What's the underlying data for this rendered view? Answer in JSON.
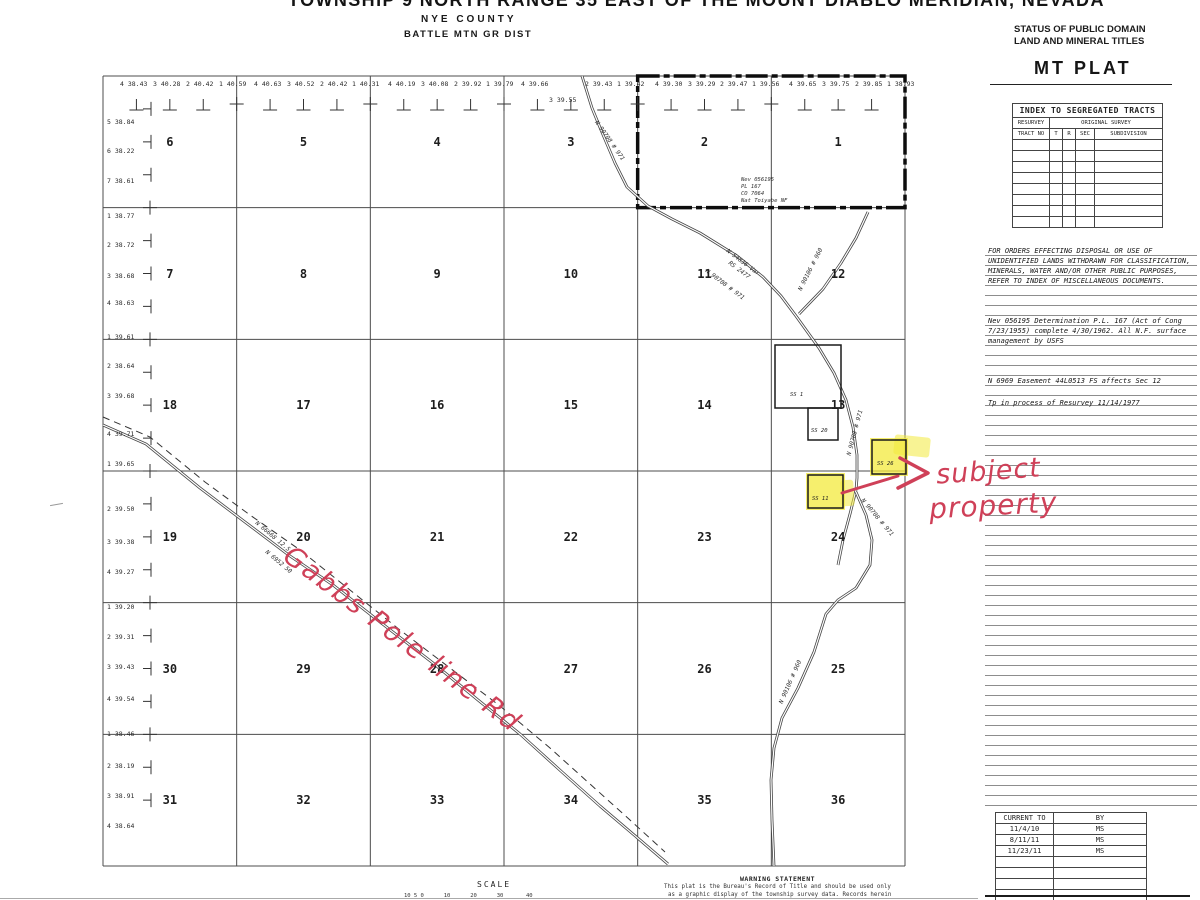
{
  "page": {
    "title": "TOWNSHIP 9 NORTH RANGE 35 EAST OF THE MOUNT DIABLO MERIDIAN, NEVADA",
    "county": "NYE COUNTY",
    "district": "BATTLE MTN GR DIST"
  },
  "corner": {
    "status_line1": "STATUS OF PUBLIC DOMAIN",
    "status_line2": "LAND AND MINERAL TITLES",
    "plat_label": "MT PLAT"
  },
  "index_table": {
    "title": "INDEX TO SEGREGATED TRACTS",
    "col_resurvey": "RESURVEY",
    "col_original": "ORIGINAL SURVEY",
    "headers": [
      "TRACT NO",
      "T",
      "R",
      "SEC",
      "SUBDIVISION"
    ],
    "empty_rows": 8
  },
  "notes": {
    "para1": [
      "FOR ORDERS EFFECTING DISPOSAL OR USE OF",
      "UNIDENTIFIED LANDS WITHDRAWN FOR CLASSIFICATION,",
      "MINERALS, WATER AND/OR OTHER PUBLIC PURPOSES,",
      "REFER TO INDEX OF MISCELLANEOUS DOCUMENTS."
    ],
    "para2": [
      "Nev 056195 Determination P.L. 167 (Act of Cong",
      "7/23/1955) complete 4/30/1962.  All N.F. surface",
      "management by USFS"
    ],
    "note3": "N 6969 Easement 44L0513 FS affects Sec 12",
    "note4": "Tp in process of Resurvey 11/14/1977"
  },
  "history_table": {
    "headers": [
      "CURRENT TO",
      "BY"
    ],
    "rows": [
      [
        "11/4/10",
        "MS"
      ],
      [
        "8/11/11",
        "MS"
      ],
      [
        "11/23/11",
        "MS"
      ]
    ],
    "empty_rows": 4
  },
  "map": {
    "sections": [
      6,
      5,
      4,
      3,
      2,
      1,
      7,
      8,
      9,
      10,
      11,
      12,
      18,
      17,
      16,
      15,
      14,
      13,
      19,
      20,
      21,
      22,
      23,
      24,
      30,
      29,
      28,
      27,
      26,
      25,
      31,
      32,
      33,
      34,
      35,
      36
    ],
    "top_labels": [
      {
        "t": "4 38.43",
        "x": 120
      },
      {
        "t": "3 40.28",
        "x": 153
      },
      {
        "t": "2 40.42",
        "x": 186
      },
      {
        "t": "1 40.59",
        "x": 219
      },
      {
        "t": "4 40.63",
        "x": 254
      },
      {
        "t": "3 40.52",
        "x": 287
      },
      {
        "t": "2 40.42",
        "x": 320
      },
      {
        "t": "1 40.31",
        "x": 352
      },
      {
        "t": "4 40.19",
        "x": 388
      },
      {
        "t": "3 40.08",
        "x": 421
      },
      {
        "t": "2 39.92",
        "x": 454
      },
      {
        "t": "1 39.79",
        "x": 486
      },
      {
        "t": "4 39.66",
        "x": 521
      },
      {
        "t": "3 39.55",
        "x": 549,
        "y": 96
      },
      {
        "t": "2 39.43",
        "x": 585
      },
      {
        "t": "1 39.42",
        "x": 617
      },
      {
        "t": "4 39.30",
        "x": 655
      },
      {
        "t": "3 39.29",
        "x": 688
      },
      {
        "t": "2 39.47",
        "x": 720
      },
      {
        "t": "1 39.56",
        "x": 752
      },
      {
        "t": "4 39.65",
        "x": 789
      },
      {
        "t": "3 39.75",
        "x": 822
      },
      {
        "t": "2 39.85",
        "x": 855
      },
      {
        "t": "1 38.93",
        "x": 887
      }
    ],
    "left_labels": [
      {
        "t": "5 38.84",
        "y": 118
      },
      {
        "t": "6 38.22",
        "y": 147
      },
      {
        "t": "7 38.61",
        "y": 177
      },
      {
        "t": "1 38.77",
        "y": 212
      },
      {
        "t": "2 38.72",
        "y": 241
      },
      {
        "t": "3 38.68",
        "y": 272
      },
      {
        "t": "4 38.63",
        "y": 299
      },
      {
        "t": "1 39.61",
        "y": 333
      },
      {
        "t": "2 38.64",
        "y": 362
      },
      {
        "t": "3 39.68",
        "y": 392
      },
      {
        "t": "4 39.71",
        "y": 430
      },
      {
        "t": "1 39.65",
        "y": 460
      },
      {
        "t": "2 39.50",
        "y": 505
      },
      {
        "t": "3 39.38",
        "y": 538
      },
      {
        "t": "4 39.27",
        "y": 568
      },
      {
        "t": "1 39.20",
        "y": 603
      },
      {
        "t": "2 39.31",
        "y": 633
      },
      {
        "t": "3 39.43",
        "y": 663
      },
      {
        "t": "4 39.54",
        "y": 695
      },
      {
        "t": "1 38.46",
        "y": 730
      },
      {
        "t": "2 38.19",
        "y": 762
      },
      {
        "t": "3 38.91",
        "y": 792
      },
      {
        "t": "4 38.64",
        "y": 822
      }
    ],
    "sec2_note": [
      "Nev 056195",
      "PL 167",
      "CO 7064",
      "Nat Toiyabe NF"
    ],
    "road_labels": [
      {
        "t": "N 90708 # 971",
        "x": 596,
        "y": 118,
        "r": 55
      },
      {
        "t": "N 54836 Var",
        "x": 727,
        "y": 247,
        "r": 37
      },
      {
        "t": "RS 2477",
        "x": 729,
        "y": 259,
        "r": 37
      },
      {
        "t": "N 90708 # 971",
        "x": 706,
        "y": 267,
        "r": 37
      },
      {
        "t": "N 90106 # 960",
        "x": 800,
        "y": 287,
        "r": -63
      },
      {
        "t": "N 90708 # 971",
        "x": 849,
        "y": 452,
        "r": -75
      },
      {
        "t": "N 90708 # 971",
        "x": 862,
        "y": 496,
        "r": 50
      },
      {
        "t": "N 90106 # 960",
        "x": 781,
        "y": 700,
        "r": -66
      },
      {
        "t": "N 66668 12.5",
        "x": 256,
        "y": 519,
        "r": 40
      },
      {
        "t": "N 6952 50",
        "x": 266,
        "y": 548,
        "r": 40
      }
    ],
    "surveys": [
      {
        "label": "SS 1",
        "x": 775,
        "y": 345,
        "w": 66,
        "h": 63,
        "hl": false,
        "lx": 790,
        "ly": 392
      },
      {
        "label": "SS 20",
        "x": 808,
        "y": 408,
        "w": 30,
        "h": 32,
        "hl": false,
        "lx": 811,
        "ly": 428
      },
      {
        "label": "SS 26",
        "x": 872,
        "y": 440,
        "w": 34,
        "h": 34,
        "hl": true,
        "lx": 877,
        "ly": 461
      },
      {
        "label": "SS 11",
        "x": 808,
        "y": 475,
        "w": 35,
        "h": 33,
        "hl": true,
        "lx": 812,
        "ly": 496
      }
    ],
    "highlight_smudges": [
      {
        "x": 894,
        "y": 436,
        "w": 36,
        "h": 20,
        "r": 6
      },
      {
        "x": 841,
        "y": 480,
        "w": 13,
        "h": 26,
        "r": -4
      }
    ],
    "roads": [
      {
        "name": "route-971-north",
        "pts": [
          [
            582,
            76
          ],
          [
            592,
            108
          ],
          [
            601,
            130
          ],
          [
            615,
            163
          ],
          [
            627,
            187
          ],
          [
            648,
            206
          ],
          [
            672,
            219
          ],
          [
            700,
            233
          ],
          [
            737,
            256
          ],
          [
            763,
            277
          ],
          [
            781,
            296
          ],
          [
            796,
            316
          ],
          [
            819,
            348
          ],
          [
            834,
            373
          ],
          [
            846,
            400
          ],
          [
            853,
            427
          ],
          [
            857,
            455
          ],
          [
            857,
            478
          ],
          [
            856,
            490
          ]
        ]
      },
      {
        "name": "route-971-branch",
        "pts": [
          [
            856,
            490
          ],
          [
            850,
            514
          ],
          [
            843,
            540
          ],
          [
            838,
            565
          ]
        ]
      },
      {
        "name": "route-960-north",
        "pts": [
          [
            868,
            212
          ],
          [
            856,
            238
          ],
          [
            841,
            263
          ],
          [
            823,
            289
          ],
          [
            799,
            314
          ]
        ]
      },
      {
        "name": "route-960-south",
        "pts": [
          [
            856,
            492
          ],
          [
            866,
            515
          ],
          [
            872,
            540
          ],
          [
            870,
            565
          ],
          [
            856,
            588
          ],
          [
            838,
            600
          ],
          [
            826,
            614
          ],
          [
            814,
            652
          ],
          [
            798,
            688
          ],
          [
            782,
            718
          ],
          [
            774,
            748
          ],
          [
            771,
            780
          ],
          [
            772,
            820
          ],
          [
            774,
            866
          ]
        ]
      },
      {
        "name": "gabbs-pole-line-road",
        "pts": [
          [
            103,
            425
          ],
          [
            146,
            444
          ],
          [
            200,
            488
          ],
          [
            245,
            522
          ],
          [
            290,
            556
          ],
          [
            333,
            585
          ],
          [
            380,
            622
          ],
          [
            433,
            663
          ],
          [
            478,
            700
          ],
          [
            520,
            734
          ],
          [
            562,
            772
          ],
          [
            600,
            806
          ],
          [
            640,
            840
          ],
          [
            668,
            864
          ]
        ]
      },
      {
        "name": "gabbs-dashed-line",
        "dashed": true,
        "pts": [
          [
            103,
            417
          ],
          [
            150,
            437
          ],
          [
            205,
            482
          ],
          [
            250,
            515
          ],
          [
            300,
            550
          ],
          [
            350,
            590
          ],
          [
            400,
            630
          ],
          [
            450,
            668
          ],
          [
            500,
            706
          ],
          [
            550,
            748
          ],
          [
            590,
            784
          ],
          [
            630,
            820
          ],
          [
            665,
            852
          ]
        ]
      }
    ]
  },
  "annotations": {
    "road_name": "Gabbs Pole line Rd",
    "subject_line1": "subject",
    "subject_line2": "property",
    "ink_color": "#cf4058",
    "highlight_color": "#f3e93c"
  },
  "scale": {
    "label": "SCALE",
    "ticks": "10 5 0      10      20      30",
    "tick_40": "40"
  },
  "warning": {
    "title": "WARNING STATEMENT",
    "lines": [
      "This plat is the Bureau's Record of Title and should be used only",
      "as a graphic display of the township survey data. Records herein"
    ]
  }
}
